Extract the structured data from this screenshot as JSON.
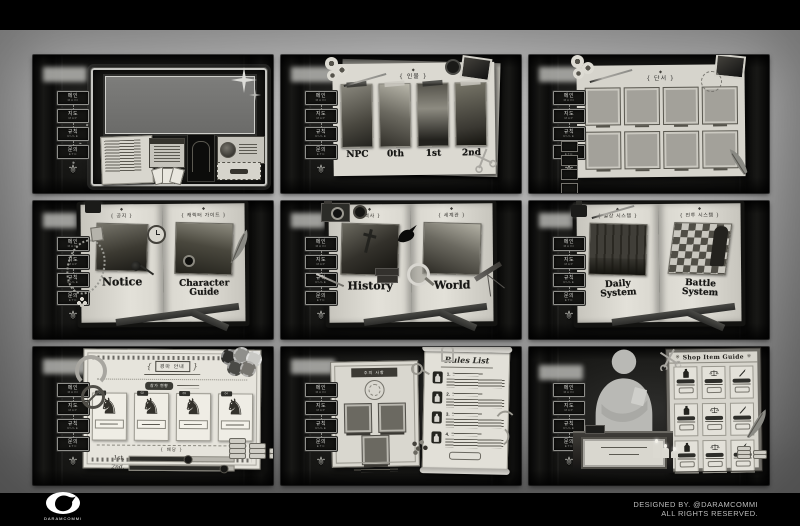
{
  "page": {
    "credits_line1": "DESIGNED BY. @DARAMCOMMI",
    "credits_line2": "ALL RIGHTS RESERVED.",
    "logo_text": "DARAMCOMMI"
  },
  "colors": {
    "background": "#000000",
    "stage": "#a8a8a8",
    "paper": "#dcdad2",
    "ink": "#1c1c1a"
  },
  "nav": {
    "ornament": "⚜",
    "items": [
      {
        "label": "메인",
        "sub": "main"
      },
      {
        "label": "지도",
        "sub": "map"
      },
      {
        "label": "규칙",
        "sub": "rule"
      },
      {
        "label": "문의",
        "sub": "etc"
      }
    ]
  },
  "characters": {
    "header_icon": "◆",
    "header": "{ 인물 }",
    "cards": [
      {
        "label": "NPC"
      },
      {
        "label": "0th"
      },
      {
        "label": "1st"
      },
      {
        "label": "2nd"
      }
    ]
  },
  "clues": {
    "header_icon": "◆",
    "header": "{ 단서 }",
    "slots": [
      {},
      {},
      {},
      {},
      {},
      {},
      {},
      {}
    ]
  },
  "books": {
    "notice": {
      "page_icon": "◆",
      "left_header": "{ 공지 }",
      "left_title": "Notice",
      "right_header": "{ 캐릭터 가이드 }",
      "right_title": "Character Guide"
    },
    "lore": {
      "page_icon": "◆",
      "left_header": "{ 역사 }",
      "left_title": "History",
      "right_header": "{ 세계관 }",
      "right_title": "World"
    },
    "systems": {
      "page_icon": "◆",
      "left_header": "{ 일상 시스템 }",
      "left_title": "Daily System",
      "right_header": "{ 전투 시스템 }",
      "right_title": "Battle System"
    }
  },
  "racing": {
    "bracket_l": "{",
    "bracket_r": "}",
    "title": "경마 안내",
    "status_label": "참가 현황",
    "divider_label": "{ 배당 }",
    "horses": [
      {
        "no": "01",
        "glyph": "♞"
      },
      {
        "no": "02",
        "glyph": "♞"
      },
      {
        "no": "03",
        "glyph": "♞"
      },
      {
        "no": "04",
        "glyph": "♞"
      }
    ],
    "bars": [
      {
        "label": "1st.",
        "value": 58
      },
      {
        "label": "2nd.",
        "value": 92
      }
    ]
  },
  "rules": {
    "banner": "주의 사항",
    "scroll_title": "Rules List",
    "items": [
      {
        "no": "1."
      },
      {
        "no": "2."
      },
      {
        "no": "3."
      },
      {
        "no": "4."
      }
    ]
  },
  "shop": {
    "ornament": "※",
    "board_title": "Shop Item Guide"
  }
}
